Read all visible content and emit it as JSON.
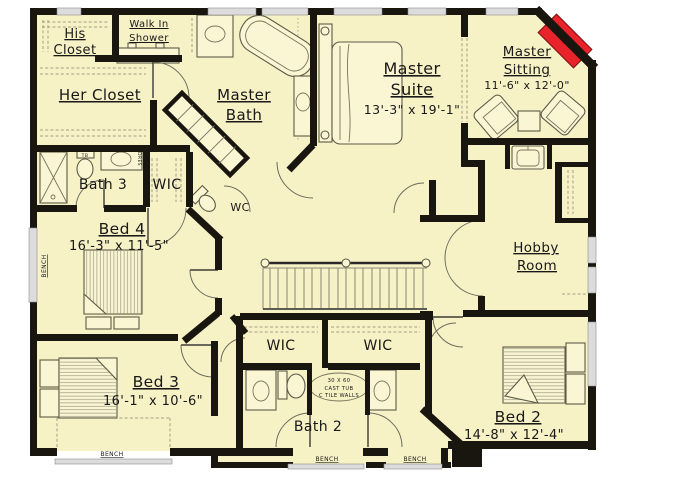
{
  "plan": {
    "rooms": {
      "his_closet": {
        "line1": "His",
        "line2": "Closet"
      },
      "walk_in_shower": {
        "line1": "Walk In",
        "line2": "Shower"
      },
      "her_closet": {
        "name": "Her Closet"
      },
      "master_bath": {
        "line1": "Master",
        "line2": "Bath"
      },
      "master_suite": {
        "line1": "Master",
        "line2": "Suite",
        "dims": "13'-3\" x 19'-1\""
      },
      "master_sitting": {
        "line1": "Master",
        "line2": "Sitting",
        "dims": "11'-6\" x 12'-0\""
      },
      "bath_3": {
        "name": "Bath 3"
      },
      "wic_hall": {
        "name": "WIC"
      },
      "wc": {
        "name": "WC"
      },
      "bed_4": {
        "name": "Bed 4",
        "dims": "16'-3\" x 11'-5\""
      },
      "hobby_room": {
        "line1": "Hobby",
        "line2": "Room"
      },
      "bed_3": {
        "name": "Bed 3",
        "dims": "16'-1\" x 10'-6\""
      },
      "wic_left": {
        "name": "WIC"
      },
      "wic_right": {
        "name": "WIC"
      },
      "bath_2": {
        "name": "Bath 2"
      },
      "bed_2": {
        "name": "Bed 2",
        "dims": "14'-8\" x 12'-4\""
      }
    },
    "annotations": {
      "tub_line1": "30 X 60",
      "tub_line2": "CAST TUB",
      "tub_line3": "C TILE WALLS",
      "bench": "BENCH",
      "tb": "TB",
      "dres": "DRES"
    },
    "colors": {
      "floor": "#f7f2c6",
      "floor2": "#faf6d4",
      "wall": "#19150f",
      "window": "#dcdcdc",
      "accent": "#e8232a",
      "line": "#6b6b5c",
      "dash": "#a49f83",
      "text": "#181818"
    }
  }
}
